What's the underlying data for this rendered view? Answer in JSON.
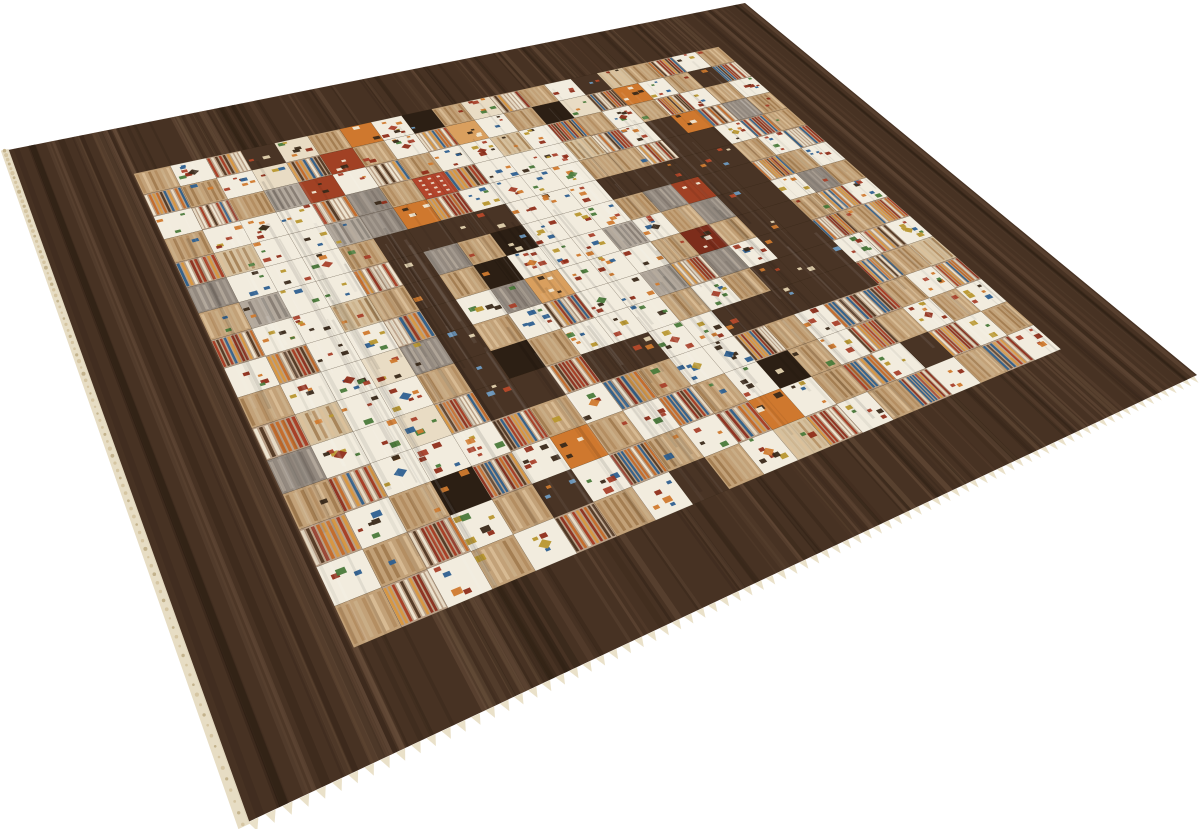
{
  "scene": {
    "type": "product photograph of a hand-knotted patchwork Gabbeh rug, viewed at an angle",
    "background_color": "#ffffff"
  },
  "rug": {
    "corners": {
      "left": [
        8,
        150
      ],
      "top": [
        745,
        3
      ],
      "right": [
        1197,
        375
      ],
      "bottom": [
        248,
        822
      ]
    },
    "border": {
      "color": "#473223",
      "streak_dark": "#261a10",
      "streak_light": "#7d614a",
      "inset_fraction": 0.11
    },
    "selvedge": {
      "strip_color": "#e6dcc2",
      "bead_color": "#d5c5a2",
      "teeth_color": "#e9dfc6"
    },
    "palette": {
      "W": "#f2ecde",
      "w": "#e9dcc4",
      "T": "#c2a178",
      "t": "#d5c09e",
      "G": "#93897f",
      "g": "#b2a89c",
      "D": "#493425",
      "d": "#6b4f3a",
      "B": "#2c1f14",
      "O": "#cf782e",
      "o": "#d99f5e",
      "R": "#a14124",
      "r": "#7d2d1b",
      "M": "#b99f86",
      "C": "#b3452c"
    },
    "stripe_colors": {
      "multi": [
        "#a63b22",
        "#e8dcc6",
        "#c46a28",
        "#2e5f8a",
        "#8d2f1e",
        "#d8973f",
        "#f0e8d4",
        "#513823"
      ],
      "tan": [
        "#b08a5c",
        "#dcc09a",
        "#9c7648",
        "#cbb089"
      ],
      "gray": [
        "#7e746c",
        "#a89d92",
        "#878077",
        "#b6ab9e"
      ]
    },
    "motif_colors": [
      "#a8402a",
      "#2e6090",
      "#3a2a1a",
      "#d07a2e",
      "#b8972f",
      "#8f2e1a",
      "#4a7a3a"
    ],
    "dark_speck_colors": [
      "#e3d2ae",
      "#cf7a2e",
      "#b84a2a",
      "#6f9bc0"
    ],
    "check_dot_color": "#ece2cf",
    "grid": {
      "cols": 20,
      "rows": 16,
      "rows_data": [
        "TWMDwTOWBTwMTWDtTMWT",
        "MTWwMRTWMoWTBwMOWTDM",
        "WMTgRWMTWWtWMTWTMWTW",
        "TWWWMGTCMWWWtMWDOMGT",
        "MtWWgGOMWWWWTTMDDWMT",
        "GWWWTDDDDWWWDDDDDTWM",
        "TgWWMDGTBWWWTGRDDMTW",
        "MWWtTDTBWWWgWTGDDWGT",
        "WMWWMDWGoWWWTrTDDTMW",
        "TWWwGDTWMWWgMGWDDMTM",
        "MtWWTDBTWWWTWTDDDWMW",
        "GWWwMDDMDDWWDDDDDMTt",
        "TMWWWMTWMTWWMTWMMTWM",
        "MWTBMWOTWMTWBTWMTWTW",
        "WTMWTDWMTWMOWTMWDMWT",
        "TMWTWMTWDTWtMWTMWTMW"
      ]
    }
  }
}
